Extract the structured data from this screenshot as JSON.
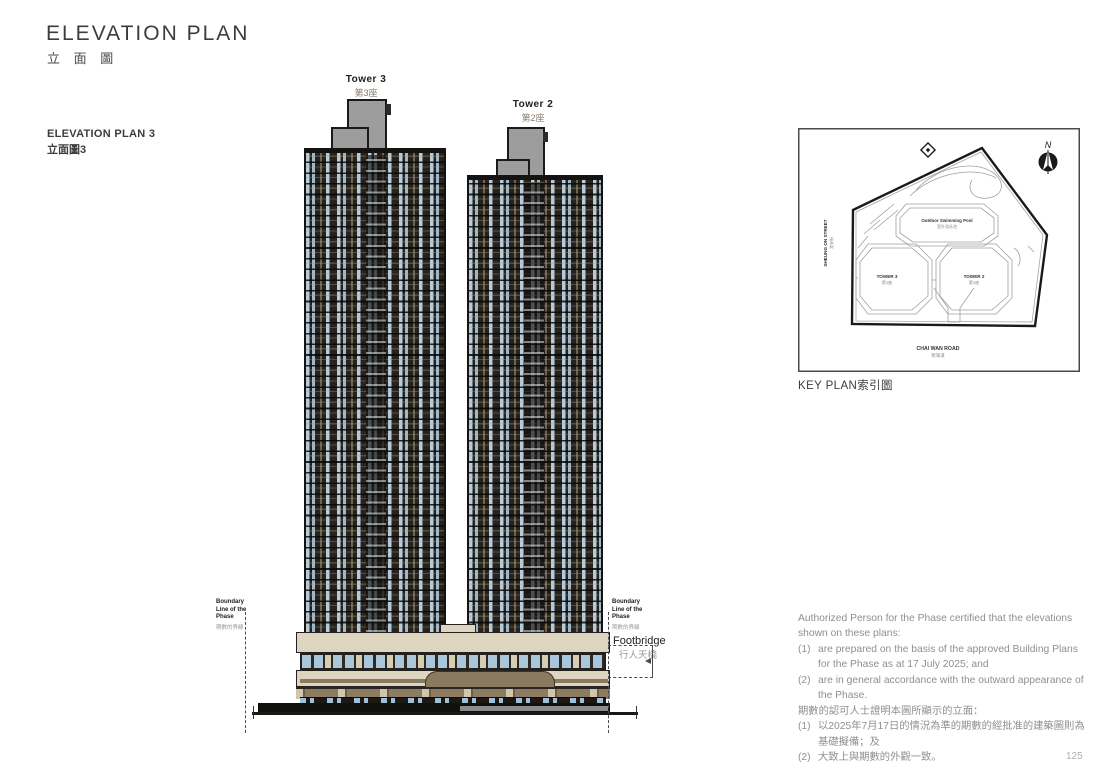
{
  "page": {
    "title": "ELEVATION PLAN",
    "title_zh": "立 面 圖",
    "page_number": "125"
  },
  "plan": {
    "label": "ELEVATION PLAN 3",
    "label_zh": "立面圖3"
  },
  "towers": {
    "tower3": {
      "en": "Tower 3",
      "zh": "第3座"
    },
    "tower2": {
      "en": "Tower 2",
      "zh": "第2座"
    }
  },
  "annotations": {
    "boundary_left": {
      "en": "Boundary Line of the Phase",
      "zh": "期數的界線"
    },
    "boundary_right": {
      "en": "Boundary Line of the Phase",
      "zh": "期數的界線"
    },
    "footbridge": {
      "en": "Footbridge",
      "zh": "行人天橋"
    }
  },
  "key_plan": {
    "caption": "KEY PLAN索引圖",
    "north": "N",
    "street_west": {
      "en": "SHEUNG ON STREET",
      "zh": "常安街"
    },
    "road_south": {
      "en": "CHAI WAN ROAD",
      "zh": "柴灣道"
    },
    "pool": {
      "en": "Outdoor Swimming Pool",
      "zh": "室外游泳池"
    },
    "tower3": {
      "en": "TOWER 3",
      "zh": "第3座"
    },
    "tower2": {
      "en": "TOWER 2",
      "zh": "第2座"
    }
  },
  "notes": {
    "intro_en": "Authorized Person for the Phase certified that the elevations shown on these plans:",
    "items_en": [
      {
        "num": "(1)",
        "text": "are prepared on the basis of the approved Building Plans for the Phase as at 17 July 2025; and"
      },
      {
        "num": "(2)",
        "text": "are in general accordance with the outward appearance of the Phase."
      }
    ],
    "intro_zh": "期數的認可人士證明本圖所顯示的立面：",
    "items_zh": [
      {
        "num": "(1)",
        "text": "以2025年7月17日的情況為準的期數的經批准的建築圖則為基礎擬備；及"
      },
      {
        "num": "(2)",
        "text": "大致上與期數的外觀一致。"
      }
    ]
  },
  "colors": {
    "facade_dark": "#27231f",
    "window_blue": "#b7cddd",
    "podium_beige": "#ddd5bf",
    "podium_brown": "#8a7a5f",
    "roof_grey": "#9d9d9d"
  }
}
